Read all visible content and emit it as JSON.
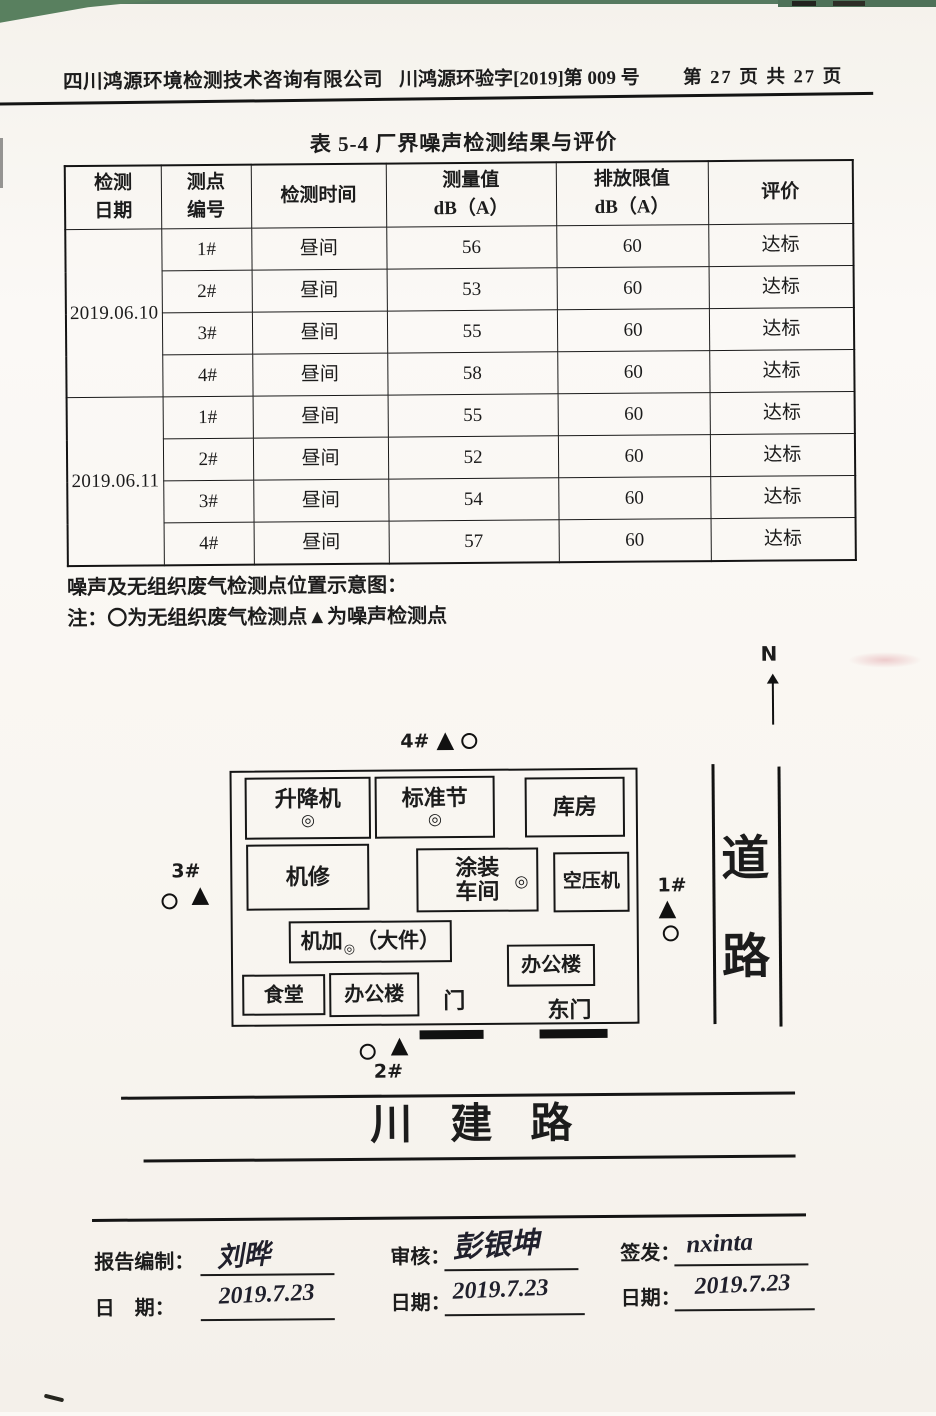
{
  "header": {
    "company": "四川鸿源环境检测技术咨询有限公司",
    "doc_number": "川鸿源环验字[2019]第 009 号",
    "page_info": "第 27 页 共 27 页"
  },
  "table": {
    "title": "表 5-4  厂界噪声检测结果与评价",
    "header": {
      "date": [
        "检测",
        "日期"
      ],
      "point": [
        "测点",
        "编号"
      ],
      "time": "检测时间",
      "value": [
        "测量值",
        "dB（A）"
      ],
      "limit": [
        "排放限值",
        "dB（A）"
      ],
      "result": "评价"
    },
    "groups": [
      {
        "date": "2019.06.10",
        "rows": [
          {
            "point": "1#",
            "time": "昼间",
            "value": "56",
            "limit": "60",
            "result": "达标"
          },
          {
            "point": "2#",
            "time": "昼间",
            "value": "53",
            "limit": "60",
            "result": "达标"
          },
          {
            "point": "3#",
            "time": "昼间",
            "value": "55",
            "limit": "60",
            "result": "达标"
          },
          {
            "point": "4#",
            "time": "昼间",
            "value": "58",
            "limit": "60",
            "result": "达标"
          }
        ]
      },
      {
        "date": "2019.06.11",
        "rows": [
          {
            "point": "1#",
            "time": "昼间",
            "value": "55",
            "limit": "60",
            "result": "达标"
          },
          {
            "point": "2#",
            "time": "昼间",
            "value": "52",
            "limit": "60",
            "result": "达标"
          },
          {
            "point": "3#",
            "time": "昼间",
            "value": "54",
            "limit": "60",
            "result": "达标"
          },
          {
            "point": "4#",
            "time": "昼间",
            "value": "57",
            "limit": "60",
            "result": "达标"
          }
        ]
      }
    ]
  },
  "notes": {
    "line1": "噪声及无组织废气检测点位置示意图：",
    "line2": "注：〇为无组织废气检测点▲为噪声检测点"
  },
  "diagram": {
    "compass_label": "N",
    "marker_4": "4#",
    "marker_3": "3#",
    "marker_1": "1#",
    "marker_2": "2#",
    "noise_marker_glyph": "▲",
    "equipment_marker": "◎",
    "buildings": {
      "lift": "升降机",
      "standard_section": "标准节",
      "warehouse": "库房",
      "machine_repair": "机修",
      "painting_workshop_line1": "涂装",
      "painting_workshop_line2": "车间",
      "air_compressor": "空压机",
      "machining": "机加",
      "machining_suffix": "（大件）",
      "office_east": "办公楼",
      "canteen": "食堂",
      "office_south": "办公楼"
    },
    "gate_label": "门",
    "east_gate_label": "东门",
    "road_char_1": "道",
    "road_char_2": "路",
    "street_name": "川建路"
  },
  "signoff": {
    "prepared_label": "报告编制：",
    "prepared_signature": "刘晔",
    "prepared_date_label": "日    期：",
    "prepared_date": "2019.7.23",
    "review_label": "审核：",
    "review_signature": "彭银坤",
    "review_date_label": "日期：",
    "review_date": "2019.7.23",
    "issue_label": "签发：",
    "issue_signature": "nxinta",
    "issue_date_label": "日期：",
    "issue_date": "2019.7.23"
  },
  "colors": {
    "ink": "#1c1c1c",
    "paper": "#faf7f2",
    "edge_green": "#5a7c64"
  }
}
